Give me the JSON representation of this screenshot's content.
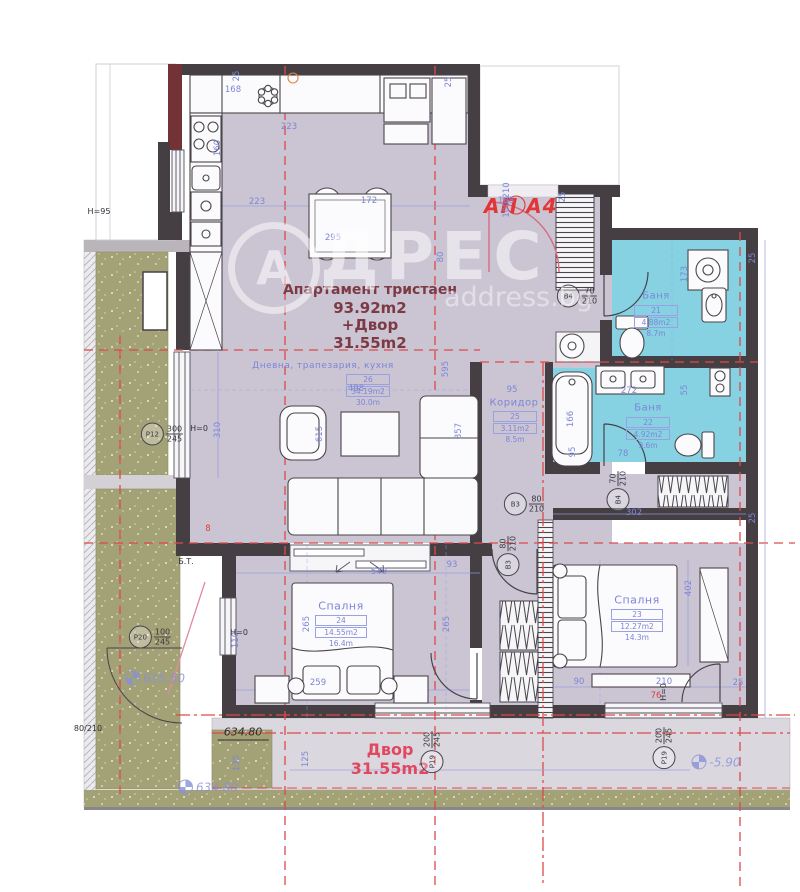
{
  "header": {
    "apartment_code": "АП А4"
  },
  "title": {
    "line1": "Апартамент тристаен",
    "line2": "93.92m2",
    "line3": "+Двор",
    "line4": "31.55m2"
  },
  "yard": {
    "name": "Двор",
    "area": "31.55m2"
  },
  "watermark": {
    "letter": "А",
    "brand": "ДРЕС",
    "site": "address.bg"
  },
  "rooms": [
    {
      "name": "Дневна, трапезария, кухня",
      "number": "26",
      "area": "34.19m2",
      "perimeter": "30.0m"
    },
    {
      "name": "Коридор",
      "number": "25",
      "area": "3.11m2",
      "perimeter": "8.5m"
    },
    {
      "name": "Баня",
      "number": "21",
      "area": "4.88m2",
      "perimeter": "8.7m"
    },
    {
      "name": "Баня",
      "number": "22",
      "area": "4.92m2",
      "perimeter": "9.6m"
    },
    {
      "name": "Спалня",
      "number": "24",
      "area": "14.55m2",
      "perimeter": "16.4m"
    },
    {
      "name": "Спалня",
      "number": "23",
      "area": "12.27m2",
      "perimeter": "14.3m"
    }
  ],
  "doors": [
    {
      "label": "В4",
      "size_top": "70",
      "size_bottom": "210",
      "x": 577,
      "y": 296,
      "rot": 0
    },
    {
      "label": "В4",
      "size_top": "70",
      "size_bottom": "210",
      "x": 618,
      "y": 491,
      "rot": 90
    },
    {
      "label": "В3",
      "size_top": "80",
      "size_bottom": "210",
      "x": 524,
      "y": 504,
      "rot": 0
    },
    {
      "label": "В3",
      "size_top": "80",
      "size_bottom": "210",
      "x": 508,
      "y": 556,
      "rot": 90
    }
  ],
  "windows": [
    {
      "label": "P12",
      "size_top": "300",
      "size_bottom": "245",
      "x": 162,
      "y": 434,
      "rot": 0
    },
    {
      "label": "P20",
      "size_top": "100",
      "size_bottom": "245",
      "x": 150,
      "y": 637,
      "rot": 0
    },
    {
      "label": "P19",
      "size_top": "200",
      "size_bottom": "245",
      "x": 432,
      "y": 752,
      "rot": 90
    },
    {
      "label": "P19",
      "size_top": "200",
      "size_bottom": "245",
      "x": 664,
      "y": 748,
      "rot": 90
    }
  ],
  "levels": [
    {
      "t": "634.80",
      "x": 243,
      "y": 733,
      "kind": "black",
      "icon": false
    },
    {
      "t": "634.80",
      "x": 208,
      "y": 787,
      "kind": "blue",
      "icon": true
    },
    {
      "t": "635.50",
      "x": 155,
      "y": 678,
      "kind": "blue",
      "icon": true
    },
    {
      "t": "-5.90",
      "x": 716,
      "y": 762,
      "kind": "blue",
      "icon": true
    }
  ],
  "dimensions": [
    {
      "t": "25",
      "x": 237,
      "y": 76,
      "r": 90
    },
    {
      "t": "168",
      "x": 233,
      "y": 90
    },
    {
      "t": "223",
      "x": 289,
      "y": 127
    },
    {
      "t": "25",
      "x": 449,
      "y": 82,
      "r": 90
    },
    {
      "t": "160",
      "x": 218,
      "y": 148,
      "r": 90
    },
    {
      "t": "223",
      "x": 257,
      "y": 202
    },
    {
      "t": "172",
      "x": 369,
      "y": 201
    },
    {
      "t": "295",
      "x": 333,
      "y": 238
    },
    {
      "t": "108",
      "x": 506,
      "y": 201
    },
    {
      "t": "25",
      "x": 563,
      "y": 197,
      "r": 90
    },
    {
      "t": "100/210",
      "x": 507,
      "y": 200,
      "r": 90
    },
    {
      "t": "173",
      "x": 685,
      "y": 274,
      "r": 90
    },
    {
      "t": "25",
      "x": 753,
      "y": 258,
      "r": 90
    },
    {
      "t": "80",
      "x": 441,
      "y": 257,
      "r": 90
    },
    {
      "t": "310",
      "x": 218,
      "y": 430,
      "r": 90
    },
    {
      "t": "498",
      "x": 356,
      "y": 389
    },
    {
      "t": "615",
      "x": 320,
      "y": 434,
      "r": 90
    },
    {
      "t": "357",
      "x": 459,
      "y": 431,
      "r": 90
    },
    {
      "t": "595",
      "x": 446,
      "y": 369,
      "r": 90
    },
    {
      "t": "95",
      "x": 512,
      "y": 390
    },
    {
      "t": "302",
      "x": 634,
      "y": 513
    },
    {
      "t": "272",
      "x": 629,
      "y": 391
    },
    {
      "t": "55",
      "x": 685,
      "y": 390,
      "r": 90
    },
    {
      "t": "95",
      "x": 573,
      "y": 452,
      "r": 90
    },
    {
      "t": "166",
      "x": 571,
      "y": 419,
      "r": 90
    },
    {
      "t": "78",
      "x": 623,
      "y": 454
    },
    {
      "t": "540",
      "x": 379,
      "y": 572
    },
    {
      "t": "265",
      "x": 307,
      "y": 624,
      "r": 90
    },
    {
      "t": "265",
      "x": 447,
      "y": 624,
      "r": 90
    },
    {
      "t": "110",
      "x": 236,
      "y": 640,
      "r": 90
    },
    {
      "t": "259",
      "x": 318,
      "y": 683
    },
    {
      "t": "402",
      "x": 689,
      "y": 588,
      "r": 90
    },
    {
      "t": "90",
      "x": 579,
      "y": 682
    },
    {
      "t": "210",
      "x": 664,
      "y": 682
    },
    {
      "t": "25",
      "x": 738,
      "y": 683
    },
    {
      "t": "93",
      "x": 452,
      "y": 565
    },
    {
      "t": "125",
      "x": 306,
      "y": 759,
      "r": 90
    },
    {
      "t": "135",
      "x": 237,
      "y": 763,
      "r": 90
    },
    {
      "t": "25",
      "x": 753,
      "y": 518,
      "r": 90
    },
    {
      "t": "76",
      "x": 656,
      "y": 696,
      "c": "red"
    },
    {
      "t": "8",
      "x": 208,
      "y": 529,
      "c": "red"
    },
    {
      "t": "H=95",
      "x": 99,
      "y": 212,
      "c": "black"
    },
    {
      "t": "H=0",
      "x": 199,
      "y": 429,
      "c": "black"
    },
    {
      "t": "H=0",
      "x": 239,
      "y": 633,
      "c": "black"
    },
    {
      "t": "H=0",
      "x": 664,
      "y": 692,
      "r": 90,
      "c": "black"
    },
    {
      "t": "Б.Т.",
      "x": 186,
      "y": 562,
      "c": "black"
    },
    {
      "t": "80/210",
      "x": 88,
      "y": 729,
      "c": "black"
    }
  ],
  "colors": {
    "wall": "#453f44",
    "maroon_wall": "#723236",
    "floor": "#cbc4d3",
    "bath": "#86d2e2",
    "yard_green": "#a3a276",
    "axis_red": "#dd4a4a",
    "dim_blue": "#7d86d6",
    "label_red": "#e23636",
    "title_maroon": "#7c3a45",
    "yard_label_pink": "#e0485f"
  }
}
